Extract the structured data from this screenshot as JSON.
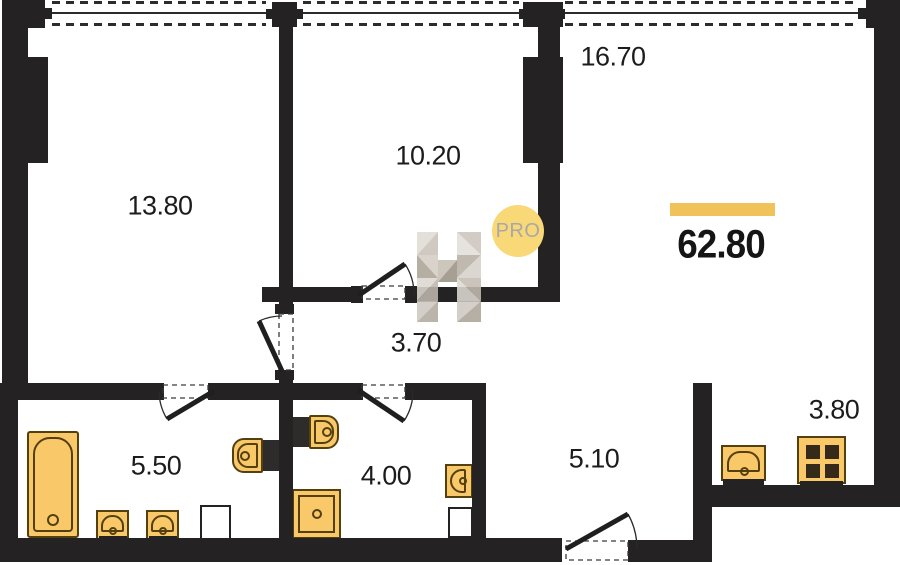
{
  "total_area": "62.80",
  "badge": "PRO",
  "rooms": {
    "r1380": "13.80",
    "r1020": "10.20",
    "r1670": "16.70",
    "h370": "3.70",
    "b550": "5.50",
    "b400": "4.00",
    "c510": "5.10",
    "k380": "3.80"
  },
  "colors": {
    "wall": "#242222",
    "fixture_fill": "#f8c869",
    "fixture_outline": "#54400f",
    "accent_bar": "#f1c259",
    "badge_bg": "#f8d877",
    "badge_text": "#a8a8a8",
    "label_text": "#1c1c1c"
  }
}
